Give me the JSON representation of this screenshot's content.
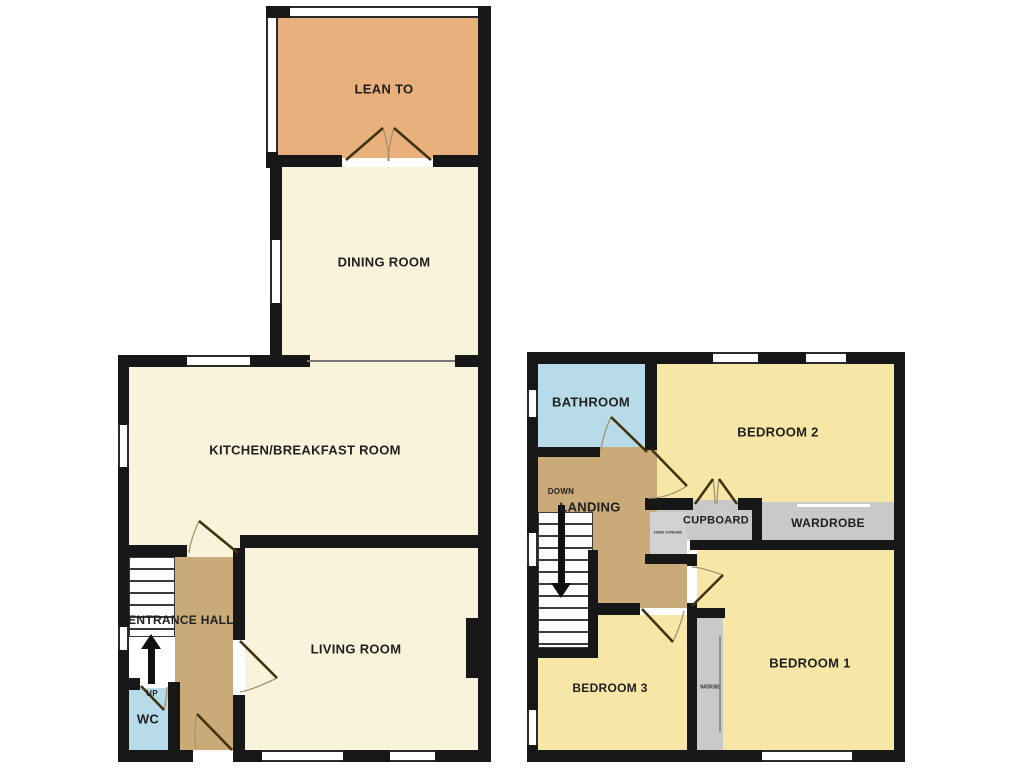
{
  "plan_title": "Two storey house floor plan",
  "colors": {
    "wall": "#171717",
    "cream_room": "#faf3dc",
    "lean_to": "#e7b07c",
    "hall_landing": "#cbaa7a",
    "wet_room_blue": "#b7dbe9",
    "bedroom_yellow": "#f7e7a7",
    "storage_grey": "#c9c9c9",
    "door_leaf": "#42330f",
    "door_arc": "#a39271",
    "text": "#1f1f1f"
  },
  "floors": [
    {
      "id": "ground-floor",
      "rooms": [
        {
          "id": "lean-to",
          "x": 278,
          "y": 18,
          "w": 200,
          "h": 140,
          "color": "#e7b07c"
        },
        {
          "id": "dining-room",
          "x": 282,
          "y": 167,
          "w": 196,
          "h": 188,
          "color": "#faf3dc"
        },
        {
          "id": "dining-kitchen-opening",
          "x": 307,
          "y": 355,
          "w": 148,
          "h": 12,
          "color": "#faf3dc"
        },
        {
          "id": "kitchen-breakfast-room",
          "x": 129,
          "y": 367,
          "w": 349,
          "h": 168,
          "color": "#faf3dc"
        },
        {
          "id": "kitchen-lower-patch",
          "x": 129,
          "y": 535,
          "w": 111,
          "h": 22,
          "color": "#faf3dc"
        },
        {
          "id": "entrance-hall",
          "x": 175,
          "y": 557,
          "w": 58,
          "h": 193,
          "color": "#cbaa7a"
        },
        {
          "id": "living-room",
          "x": 245,
          "y": 548,
          "w": 233,
          "h": 202,
          "color": "#faf3dc"
        },
        {
          "id": "stair-run-out",
          "x": 129,
          "y": 636,
          "w": 46,
          "h": 52,
          "color": "#ffffff"
        },
        {
          "id": "wc",
          "x": 129,
          "y": 688,
          "w": 39,
          "h": 62,
          "color": "#b7dbe9"
        }
      ],
      "walls": [
        {
          "x": 266,
          "y": 6,
          "w": 26,
          "h": 12
        },
        {
          "x": 478,
          "y": 6,
          "w": 13,
          "h": 756
        },
        {
          "x": 266,
          "y": 152,
          "w": 12,
          "h": 16
        },
        {
          "x": 266,
          "y": 155,
          "w": 76,
          "h": 12
        },
        {
          "x": 433,
          "y": 155,
          "w": 58,
          "h": 12
        },
        {
          "x": 270,
          "y": 167,
          "w": 12,
          "h": 73
        },
        {
          "x": 270,
          "y": 303,
          "w": 12,
          "h": 52
        },
        {
          "x": 118,
          "y": 355,
          "w": 154,
          "h": 12
        },
        {
          "x": 250,
          "y": 355,
          "w": 60,
          "h": 12
        },
        {
          "x": 455,
          "y": 355,
          "w": 36,
          "h": 12
        },
        {
          "x": 118,
          "y": 355,
          "w": 11,
          "h": 407
        },
        {
          "x": 240,
          "y": 535,
          "w": 238,
          "h": 13
        },
        {
          "x": 129,
          "y": 545,
          "w": 58,
          "h": 12
        },
        {
          "x": 175,
          "y": 545,
          "w": 8,
          "h": 12
        },
        {
          "x": 233,
          "y": 548,
          "w": 12,
          "h": 92
        },
        {
          "x": 233,
          "y": 695,
          "w": 12,
          "h": 57
        },
        {
          "x": 168,
          "y": 682,
          "w": 12,
          "h": 70
        },
        {
          "x": 118,
          "y": 678,
          "w": 22,
          "h": 12
        },
        {
          "x": 118,
          "y": 750,
          "w": 372,
          "h": 12
        },
        {
          "x": 466,
          "y": 618,
          "w": 14,
          "h": 60
        }
      ],
      "windows": [
        {
          "x": 290,
          "y": 6,
          "w": 188,
          "h": 12,
          "o": "h"
        },
        {
          "x": 266,
          "y": 18,
          "w": 12,
          "h": 134,
          "o": "v"
        },
        {
          "x": 270,
          "y": 240,
          "w": 12,
          "h": 63,
          "o": "v"
        },
        {
          "x": 187,
          "y": 355,
          "w": 63,
          "h": 12,
          "o": "h"
        },
        {
          "x": 118,
          "y": 425,
          "w": 11,
          "h": 42,
          "o": "v"
        },
        {
          "x": 118,
          "y": 627,
          "w": 11,
          "h": 23,
          "o": "v"
        },
        {
          "x": 262,
          "y": 750,
          "w": 81,
          "h": 12,
          "o": "h"
        },
        {
          "x": 390,
          "y": 750,
          "w": 45,
          "h": 12,
          "o": "h"
        },
        {
          "x": 193,
          "y": 750,
          "w": 40,
          "h": 12,
          "o": "gap"
        }
      ],
      "stairs": [
        {
          "id": "stairs-up",
          "x": 129,
          "y": 557,
          "w": 46,
          "h": 80,
          "step": 12
        }
      ],
      "lines": [
        {
          "x": 307,
          "y": 360,
          "w": 148,
          "h": 2,
          "color": "#777777"
        }
      ],
      "labels": [
        {
          "id": "lean-to",
          "text": "LEAN TO",
          "x": 384,
          "y": 89,
          "size": 13
        },
        {
          "id": "dining-room",
          "text": "DINING ROOM",
          "x": 384,
          "y": 262,
          "size": 13
        },
        {
          "id": "kitchen-breakfast-room",
          "text": "KITCHEN/BREAKFAST ROOM",
          "x": 305,
          "y": 450,
          "size": 13
        },
        {
          "id": "entrance-hall",
          "text": "ENTRANCE HALL",
          "x": 181,
          "y": 620,
          "size": 12
        },
        {
          "id": "living-room",
          "text": "LIVING ROOM",
          "x": 356,
          "y": 649,
          "size": 13
        },
        {
          "id": "wc",
          "text": "WC",
          "x": 148,
          "y": 719,
          "size": 13
        },
        {
          "id": "up",
          "text": "UP",
          "x": 152,
          "y": 694,
          "size": 8
        }
      ],
      "arrows": [
        {
          "id": "up-arrow",
          "cx": 151,
          "y1": 634,
          "y2": 684,
          "dir": "up"
        }
      ],
      "doors": [
        {
          "id": "lean-to-door-left",
          "leaf": "M346,160 L383,128",
          "arc": "M383,128 Q389,149 389,161"
        },
        {
          "id": "lean-to-door-right",
          "leaf": "M431,160 L394,128",
          "arc": "M394,128 Q388,149 388,161"
        },
        {
          "id": "kitchen-door",
          "leaf": "M238,553 L199,521",
          "arc": "M199,521 Q190,541 189,553"
        },
        {
          "id": "living-room-door",
          "leaf": "M240,641 L277,678",
          "arc": "M277,678 Q250,691 240,692"
        },
        {
          "id": "front-door",
          "leaf": "M232,750 L197,714",
          "arc": "M197,714 Q193,734 196,749"
        },
        {
          "id": "wc-door",
          "leaf": "M141,686 L164,710",
          "arc": "M164,710 Q167,697 167,687"
        }
      ]
    },
    {
      "id": "first-floor",
      "rooms": [
        {
          "id": "bathroom",
          "x": 538,
          "y": 364,
          "w": 107,
          "h": 83,
          "color": "#b7dbe9"
        },
        {
          "id": "bedroom-2",
          "x": 657,
          "y": 364,
          "w": 237,
          "h": 141,
          "color": "#f7e7a7"
        },
        {
          "id": "landing-upper",
          "x": 538,
          "y": 447,
          "w": 119,
          "h": 65,
          "color": "#cbaa7a"
        },
        {
          "id": "landing-lower",
          "x": 593,
          "y": 512,
          "w": 94,
          "h": 96,
          "color": "#cbaa7a"
        },
        {
          "id": "cupboard",
          "x": 657,
          "y": 500,
          "w": 95,
          "h": 40,
          "color": "#c9c9c9"
        },
        {
          "id": "airing-cupboard",
          "x": 650,
          "y": 512,
          "w": 37,
          "h": 42,
          "color": "#d2d2d4"
        },
        {
          "id": "wardrobe",
          "x": 762,
          "y": 502,
          "w": 132,
          "h": 38,
          "color": "#c9c9c9"
        },
        {
          "id": "bedroom-1",
          "x": 697,
          "y": 550,
          "w": 197,
          "h": 202,
          "color": "#f7e7a7"
        },
        {
          "id": "bedroom-3-main",
          "x": 538,
          "y": 658,
          "w": 149,
          "h": 94,
          "color": "#f7e7a7"
        },
        {
          "id": "bedroom-3-upper",
          "x": 598,
          "y": 615,
          "w": 89,
          "h": 43,
          "color": "#f7e7a7"
        },
        {
          "id": "bedroom-1-wardrobe",
          "x": 697,
          "y": 618,
          "w": 26,
          "h": 134,
          "color": "#c9c9c9"
        }
      ],
      "walls": [
        {
          "x": 527,
          "y": 352,
          "w": 378,
          "h": 12
        },
        {
          "x": 527,
          "y": 352,
          "w": 11,
          "h": 410
        },
        {
          "x": 894,
          "y": 352,
          "w": 11,
          "h": 410
        },
        {
          "x": 527,
          "y": 750,
          "w": 378,
          "h": 12
        },
        {
          "x": 538,
          "y": 447,
          "w": 62,
          "h": 10
        },
        {
          "x": 645,
          "y": 364,
          "w": 12,
          "h": 86
        },
        {
          "x": 645,
          "y": 498,
          "w": 48,
          "h": 12
        },
        {
          "x": 738,
          "y": 498,
          "w": 16,
          "h": 12
        },
        {
          "x": 752,
          "y": 498,
          "w": 10,
          "h": 47
        },
        {
          "x": 690,
          "y": 540,
          "w": 204,
          "h": 10
        },
        {
          "x": 645,
          "y": 554,
          "w": 52,
          "h": 10
        },
        {
          "x": 687,
          "y": 554,
          "w": 10,
          "h": 12
        },
        {
          "x": 588,
          "y": 550,
          "w": 10,
          "h": 108
        },
        {
          "x": 527,
          "y": 648,
          "w": 66,
          "h": 10
        },
        {
          "x": 593,
          "y": 603,
          "w": 47,
          "h": 12
        },
        {
          "x": 687,
          "y": 603,
          "w": 10,
          "h": 15
        },
        {
          "x": 687,
          "y": 608,
          "w": 38,
          "h": 10
        },
        {
          "x": 687,
          "y": 618,
          "w": 10,
          "h": 134
        }
      ],
      "windows": [
        {
          "x": 713,
          "y": 352,
          "w": 45,
          "h": 12,
          "o": "h"
        },
        {
          "x": 806,
          "y": 352,
          "w": 40,
          "h": 12,
          "o": "h"
        },
        {
          "x": 527,
          "y": 390,
          "w": 11,
          "h": 27,
          "o": "v"
        },
        {
          "x": 527,
          "y": 533,
          "w": 11,
          "h": 33,
          "o": "v"
        },
        {
          "x": 527,
          "y": 710,
          "w": 11,
          "h": 35,
          "o": "v"
        },
        {
          "x": 762,
          "y": 750,
          "w": 90,
          "h": 12,
          "o": "h"
        }
      ],
      "stairs": [
        {
          "id": "stairs-down",
          "x": 538,
          "y": 512,
          "w": 55,
          "h": 136,
          "step": 12
        }
      ],
      "lines": [
        {
          "x": 797,
          "y": 504,
          "w": 73,
          "h": 3,
          "color": "#ffffff"
        },
        {
          "x": 719,
          "y": 636,
          "w": 2,
          "h": 96,
          "color": "#909090"
        }
      ],
      "labels": [
        {
          "id": "bathroom",
          "text": "BATHROOM",
          "x": 591,
          "y": 402,
          "size": 13
        },
        {
          "id": "bedroom-2",
          "text": "BEDROOM 2",
          "x": 778,
          "y": 432,
          "size": 13
        },
        {
          "id": "down",
          "text": "DOWN",
          "x": 561,
          "y": 492,
          "size": 8
        },
        {
          "id": "landing",
          "text": "LANDING",
          "x": 590,
          "y": 507,
          "size": 13
        },
        {
          "id": "cupboard",
          "text": "CUPBOARD",
          "x": 716,
          "y": 521,
          "size": 11
        },
        {
          "id": "wardrobe",
          "text": "WARDROBE",
          "x": 828,
          "y": 523,
          "size": 12
        },
        {
          "id": "airing-cupboard",
          "text": "AIRING CUPBOARD",
          "x": 668,
          "y": 533,
          "size": 3.5,
          "sx": 0.75
        },
        {
          "id": "bedroom-3",
          "text": "BEDROOM 3",
          "x": 610,
          "y": 688,
          "size": 12
        },
        {
          "id": "bedroom-1",
          "text": "BEDROOM 1",
          "x": 810,
          "y": 663,
          "size": 13
        },
        {
          "id": "bedroom-1-wardrobe",
          "text": "WARDROBE",
          "x": 710,
          "y": 688,
          "size": 5,
          "sx": 0.6
        }
      ],
      "arrows": [
        {
          "id": "down-arrow",
          "cx": 561,
          "y1": 505,
          "y2": 598,
          "dir": "down"
        }
      ],
      "doors": [
        {
          "id": "bathroom-door",
          "leaf": "M647,452 L611,417",
          "arc": "M611,417 Q602,437 601,451"
        },
        {
          "id": "bedroom-2-door",
          "leaf": "M651,449 L687,486",
          "arc": "M687,486 Q666,499 648,498"
        },
        {
          "id": "cupboard-door-left",
          "leaf": "M695,504 L713,479",
          "arc": "M713,479 Q715,494 715,504"
        },
        {
          "id": "cupboard-door-right",
          "leaf": "M737,504 L719,479",
          "arc": "M719,479 Q717,494 717,504"
        },
        {
          "id": "bedroom-1-door",
          "leaf": "M692,606 L723,575",
          "arc": "M723,575 Q700,567 692,567"
        },
        {
          "id": "bedroom-3-door",
          "leaf": "M642,609 L673,642",
          "arc": "M673,642 Q682,621 684,611"
        }
      ]
    }
  ]
}
